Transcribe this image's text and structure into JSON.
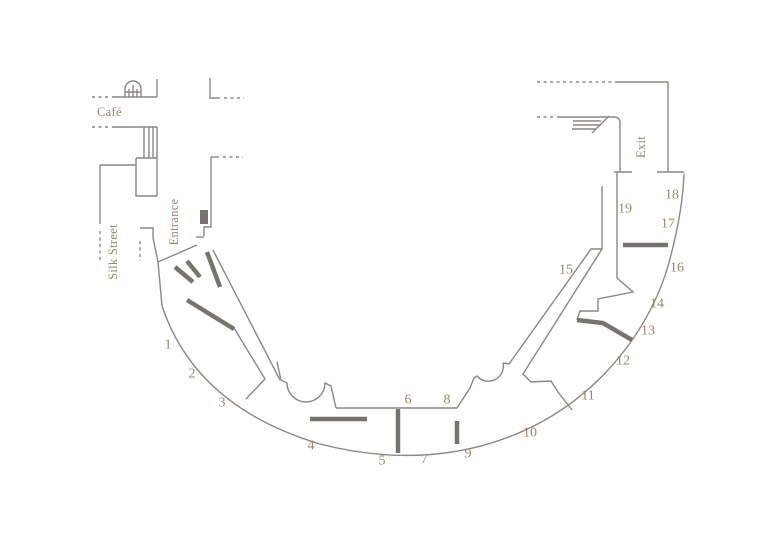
{
  "palette": {
    "background": "#ffffff",
    "wall_line": "#8b8680",
    "partition": "#77736d",
    "label_text": "#9b8767"
  },
  "labels": {
    "cafe": "Café",
    "silk_street": "Silk Street",
    "entrance": "Entrance",
    "exit": "Exit"
  },
  "sections": [
    {
      "n": "1",
      "x": 168,
      "y": 344
    },
    {
      "n": "2",
      "x": 192,
      "y": 373
    },
    {
      "n": "3",
      "x": 222,
      "y": 402
    },
    {
      "n": "4",
      "x": 311,
      "y": 445
    },
    {
      "n": "5",
      "x": 382,
      "y": 460
    },
    {
      "n": "6",
      "x": 408,
      "y": 399
    },
    {
      "n": "7",
      "x": 424,
      "y": 459
    },
    {
      "n": "8",
      "x": 447,
      "y": 399
    },
    {
      "n": "9",
      "x": 468,
      "y": 453
    },
    {
      "n": "10",
      "x": 530,
      "y": 432
    },
    {
      "n": "11",
      "x": 588,
      "y": 395
    },
    {
      "n": "12",
      "x": 623,
      "y": 360
    },
    {
      "n": "13",
      "x": 648,
      "y": 330
    },
    {
      "n": "14",
      "x": 657,
      "y": 303
    },
    {
      "n": "15",
      "x": 566,
      "y": 269
    },
    {
      "n": "16",
      "x": 677,
      "y": 267
    },
    {
      "n": "17",
      "x": 668,
      "y": 223
    },
    {
      "n": "18",
      "x": 672,
      "y": 194
    },
    {
      "n": "19",
      "x": 625,
      "y": 208
    }
  ]
}
